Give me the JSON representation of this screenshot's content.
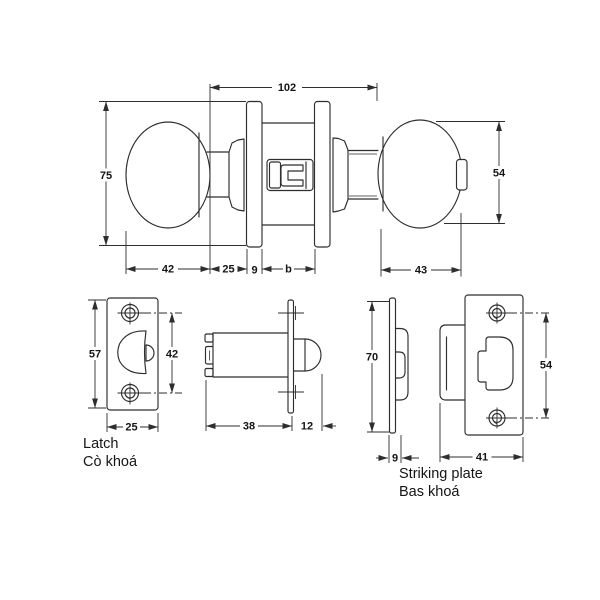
{
  "drawing": {
    "type": "technical-dimension-drawing",
    "subject": "tubular knob lockset",
    "colors": {
      "line": "#2e2e2e",
      "text": "#151515",
      "background": "#ffffff"
    }
  },
  "knob_assembly": {
    "overall_length": "102",
    "rose_height": "75",
    "knob_diameter_outside": "54",
    "inside_knob_width": "42",
    "inside_neck_length": "25",
    "rose_thickness": "9",
    "door_thickness": "b",
    "outside_knob_width": "43"
  },
  "latch_front": {
    "plate_height": "57",
    "screw_spacing": "42",
    "plate_width": "25"
  },
  "latch_side": {
    "case_length": "38",
    "bolt_projection": "12"
  },
  "strike_side": {
    "plate_height": "70",
    "plate_thickness": "9"
  },
  "strike_front": {
    "screw_spacing": "54",
    "plate_width": "41"
  },
  "captions": {
    "latch_en": "Latch",
    "latch_vi": "Cò khoá",
    "strike_en": "Striking plate",
    "strike_vi": "Bas khoá"
  }
}
